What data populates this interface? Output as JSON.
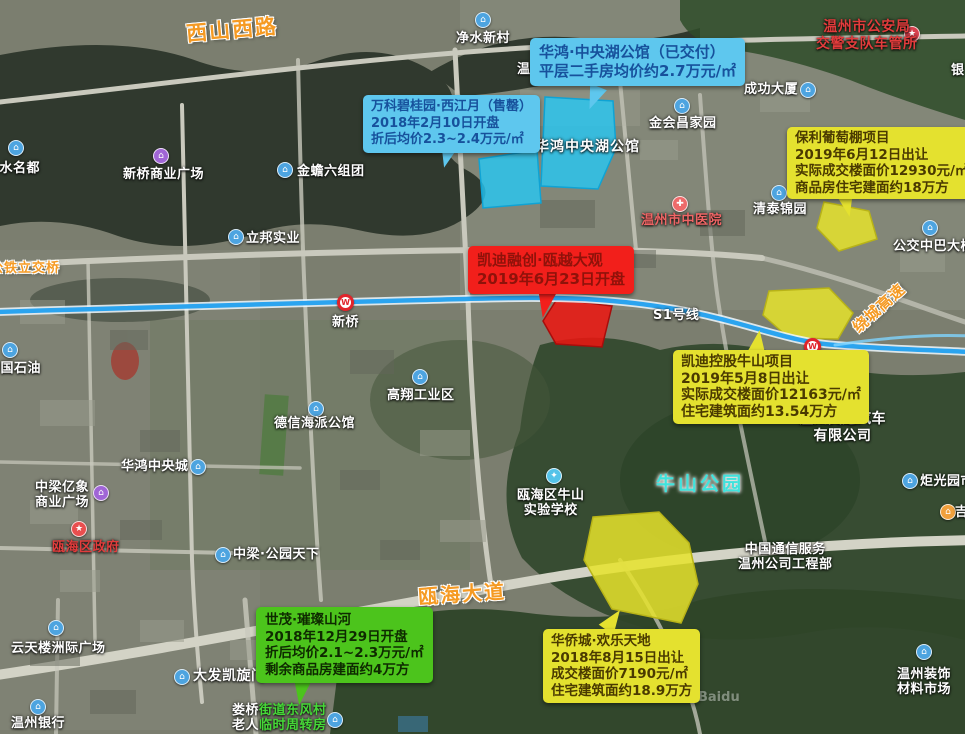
{
  "map": {
    "watermark": "Baidu"
  },
  "transit": {
    "line_label": "S1号线",
    "line_color": "#2ba4ef"
  },
  "roads": {
    "xishanxilu": "西山西路",
    "ouhaidadao": "瓯海大道",
    "gongtielijiao": "公铁立交桥",
    "raochenggaosu": "绕城高速"
  },
  "parks": {
    "niushan": "牛山公园"
  },
  "parcels": {
    "huahong_lake_area": {
      "name": "华鸿中央湖公馆地块",
      "color": "#25c8f5"
    },
    "kaidi_rongchuang_area": {
      "name": "凯迪融创瓯越大观地块",
      "color": "#ee1511"
    },
    "baoli_area": {
      "name": "保利葡萄棚地块",
      "color": "#e6e32b"
    },
    "kaidi_niushan_area": {
      "name": "凯迪控股牛山地块",
      "color": "#e6e32b"
    },
    "huaqiaocheng_area": {
      "name": "华侨城欢乐天地地块",
      "color": "#e6e32b"
    }
  },
  "bubbles": {
    "huahong": {
      "color": "#5ec7ee",
      "text_color": "#17519c",
      "lines": [
        "华鸿·中央湖公馆（已交付）",
        "平层二手房均价约2.7万元/㎡"
      ]
    },
    "wanke": {
      "color": "#5ec7ee",
      "text_color": "#17519c",
      "lines": [
        "万科碧桂园·西江月（售罄）",
        "2018年2月10日开盘",
        "折后均价2.3~2.4万元/㎡"
      ]
    },
    "baoli": {
      "color": "#e4e12f",
      "text_color": "#4a3a00",
      "lines": [
        "保利葡萄棚项目",
        "2019年6月12日出让",
        "实际成交楼面价12930元/㎡",
        "商品房住宅建面约18万方"
      ]
    },
    "kaidi_rongchuang": {
      "color": "#f21f1b",
      "text_color": "#8f120a",
      "lines": [
        "凯迪融创·瓯越大观",
        "2019年6月23日开盘"
      ]
    },
    "kaidi_niushan": {
      "color": "#e4e12f",
      "text_color": "#4a3a00",
      "lines": [
        "凯迪控股牛山项目",
        "2019年5月8日出让",
        "实际成交楼面价12163元/㎡",
        "住宅建筑面约13.54万方"
      ]
    },
    "shimao": {
      "color": "#4cc41c",
      "text_color": "#0e2a00",
      "lines": [
        "世茂·璀璨山河",
        "2018年12月29日开盘",
        "折后均价2.1~2.3万元/㎡",
        "剩余商品房建面约4万方"
      ]
    },
    "huaqiaocheng": {
      "color": "#e4e12f",
      "text_color": "#4a3a00",
      "lines": [
        "华侨城·欢乐天地",
        "2018年8月15日出让",
        "成交楼面价7190元/㎡",
        "住宅建筑面约18.9万方"
      ]
    }
  },
  "pois": {
    "jingshuixincun": "净水新村",
    "shanshuimingdu": "山水名都",
    "xinqiao_plaza": "新桥商业广场",
    "jinchan": "金蟾六组团",
    "libang": "立邦实业",
    "jinhuichang": "金会昌家园",
    "chenggong": "成功大厦",
    "qingtai": "清泰锦园",
    "zhongyiyuan": "温州市中医院",
    "gongjiao": "公交中巴大楼",
    "yinhang_partial": "银",
    "xinqiao_station": "新桥",
    "gaoxiang": "高翔工业区",
    "dexin": "德信海派公馆",
    "zhongshiyou": "中国石油",
    "huahong_city": "华鸿中央城",
    "zhongliang_yixiang": {
      "l1": "中梁亿象",
      "l2": "商业广场"
    },
    "ouhai_gov": "瓯海区政府",
    "zhongliang_park": "中梁·公园天下",
    "niushan_school": {
      "l1": "瓯海区牛山",
      "l2": "实验学校"
    },
    "tongxin": {
      "l1": "中国通信服务",
      "l2": "温州公司工程部"
    },
    "jiaotong": {
      "l1": "温州交通汽车",
      "l2": "有限公司"
    },
    "juguang": "炬光园市场",
    "ji_partial": "吉",
    "yuntianlou": "云天楼洲际广场",
    "dafa": "大发凯旋门",
    "wenzhou_bank": "温州银行",
    "louqiao": {
      "l1_white": "娄桥",
      "l1_green": "街道东风村",
      "l2_white": "老人",
      "l2_green": "临时周转房"
    },
    "zhuangshi": {
      "l1": "温州装饰",
      "l2": "材料市场"
    },
    "cheguansuo": {
      "l1": "温州市公安局",
      "l2": "交警支队车管所"
    },
    "huahong_lake": "华鸿中央湖公馆",
    "wenzhou_partial": "温州"
  }
}
